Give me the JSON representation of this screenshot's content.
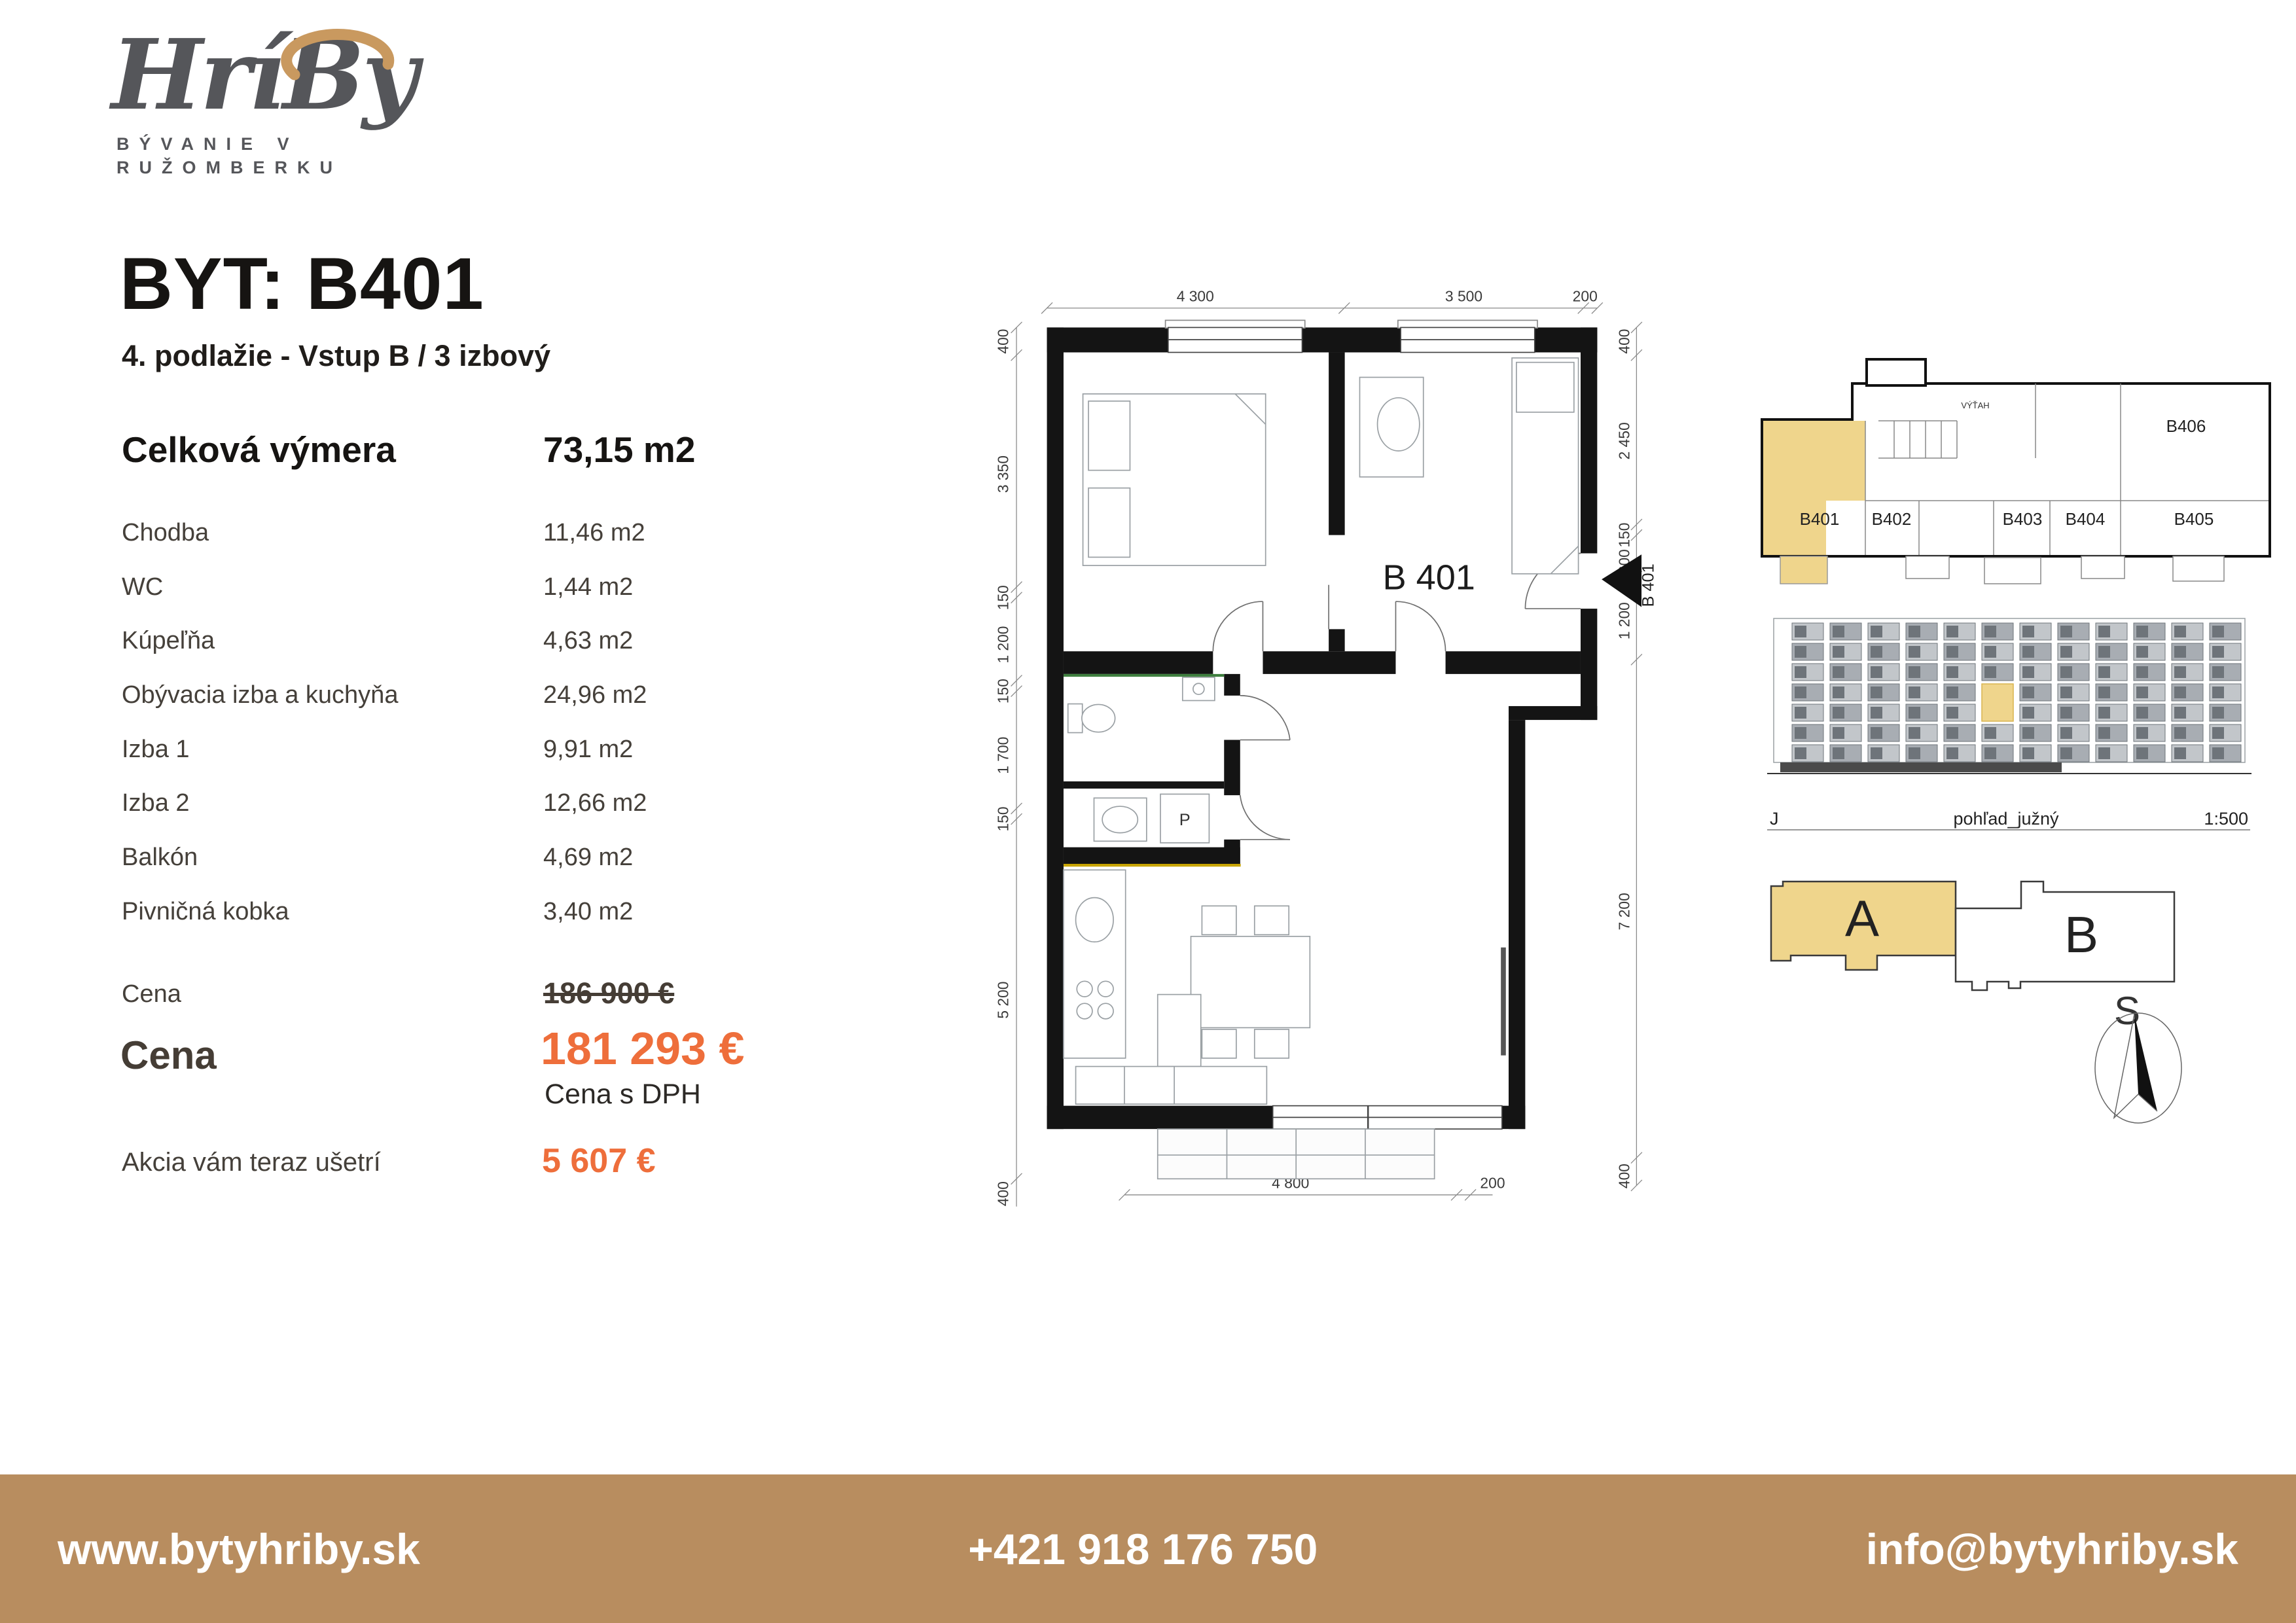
{
  "brand": {
    "name": "HríBy",
    "tagline_line1": "BÝVANIE V",
    "tagline_line2": "RUŽOMBERKU"
  },
  "listing": {
    "title": "BYT: B401",
    "subtitle": "4. podlažie - Vstup B / 3 izbový"
  },
  "summary": {
    "label": "Celková výmera",
    "value": "73,15 m2"
  },
  "rooms": [
    {
      "label": "Chodba",
      "value": "11,46 m2"
    },
    {
      "label": "WC",
      "value": "1,44 m2"
    },
    {
      "label": "Kúpeľňa",
      "value": "4,63 m2"
    },
    {
      "label": "Obývacia izba a kuchyňa",
      "value": "24,96 m2"
    },
    {
      "label": "Izba 1",
      "value": "9,91 m2"
    },
    {
      "label": "Izba 2",
      "value": "12,66 m2"
    },
    {
      "label": "Balkón",
      "value": "4,69 m2"
    },
    {
      "label": "Pivničná kobka",
      "value": "3,40 m2"
    }
  ],
  "pricing": {
    "old_label": "Cena",
    "old_price": "186 900 €",
    "new_label": "Cena",
    "new_price": "181 293 €",
    "vat_note": "Cena s DPH",
    "savings_label": "Akcia vám teraz ušetrí",
    "savings": "5 607 €"
  },
  "floorplan": {
    "unit_label": "B 401",
    "entry_label": "B 401",
    "washer_label": "P",
    "dims": {
      "top": [
        "4 300",
        "3 500",
        "200"
      ],
      "bottom": [
        "4 800",
        "200"
      ],
      "left": [
        "400",
        "3 350",
        "150",
        "1 200",
        "150",
        "1 700",
        "150",
        "5 200",
        "400"
      ],
      "right": [
        "400",
        "2 450",
        "150",
        "600",
        "1 200",
        "7 200",
        "400"
      ]
    }
  },
  "site_plan": {
    "elevator": "VÝŤAH",
    "units": [
      "B401",
      "B402",
      "B403",
      "B404",
      "B405",
      "B406"
    ]
  },
  "elevation": {
    "direction": "J",
    "caption": "pohľad_južný",
    "scale": "1:500"
  },
  "blocks": {
    "block_a": "A",
    "block_b": "B",
    "compass_label": "S"
  },
  "footer": {
    "website": "www.bytyhriby.sk",
    "phone": "+421 918 176 750",
    "email": "info@bytyhriby.sk"
  },
  "colors": {
    "accent_orange": "#ee6e3b",
    "highlight_yellow": "#efd58c",
    "footer_brown": "#b88d5f",
    "logo_gray": "#55565a",
    "logo_tan": "#c9995f"
  }
}
